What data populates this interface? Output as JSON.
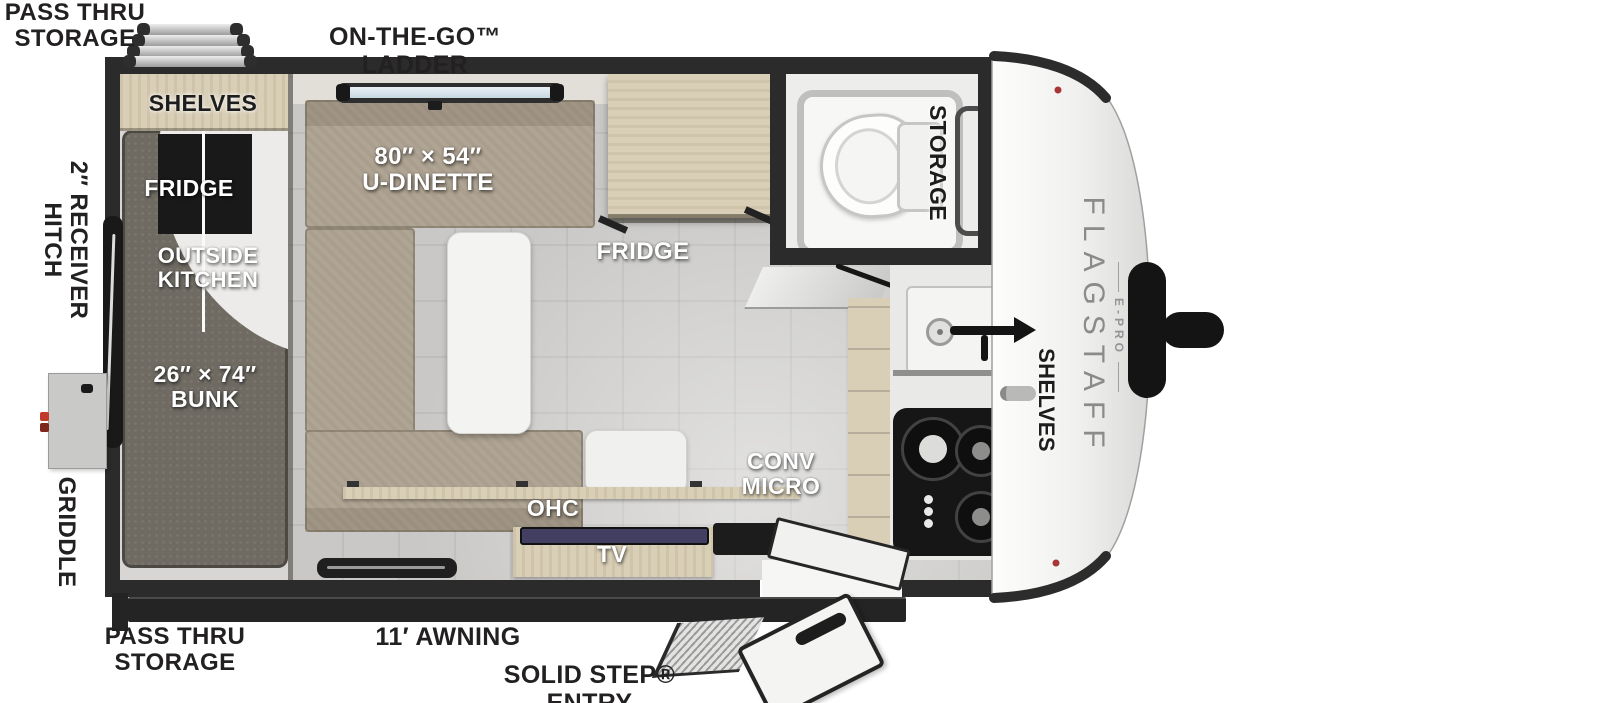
{
  "plan": {
    "brand": "FLAGSTAFF",
    "brand_sub": "E-PRO",
    "exterior": {
      "pass_thru_top": "PASS THRU\nSTORAGE",
      "ladder": "ON-THE-GO™ LADDER",
      "receiver_hitch": "2″ RECEIVER\nHITCH",
      "griddle": "GRIDDLE",
      "pass_thru_bottom": "PASS THRU\nSTORAGE",
      "awning": "11′ AWNING",
      "entry": "SOLID STEP® ENTRY"
    },
    "interior": {
      "shelves_rear": "SHELVES",
      "outside_fridge": "FRIDGE",
      "outside_kitchen": "OUTSIDE\nKITCHEN",
      "bunk": "26″ × 74″\nBUNK",
      "dinette": "80″ × 54″\nU-DINETTE",
      "fridge": "FRIDGE",
      "conv_micro": "CONV\nMICRO",
      "ohc": "OHC",
      "tv": "TV",
      "bath_storage": "STORAGE",
      "front_shelves": "SHELVES"
    },
    "colors": {
      "wall": "#2b2b2b",
      "floor": "#c9c8c6",
      "wood": "#d9cfb7",
      "bench": "#b0a594",
      "mattress": "#6f6b63",
      "nose": "#f2f2f1",
      "accent_red": "#a93636",
      "tv_screen": "#433f63"
    }
  }
}
